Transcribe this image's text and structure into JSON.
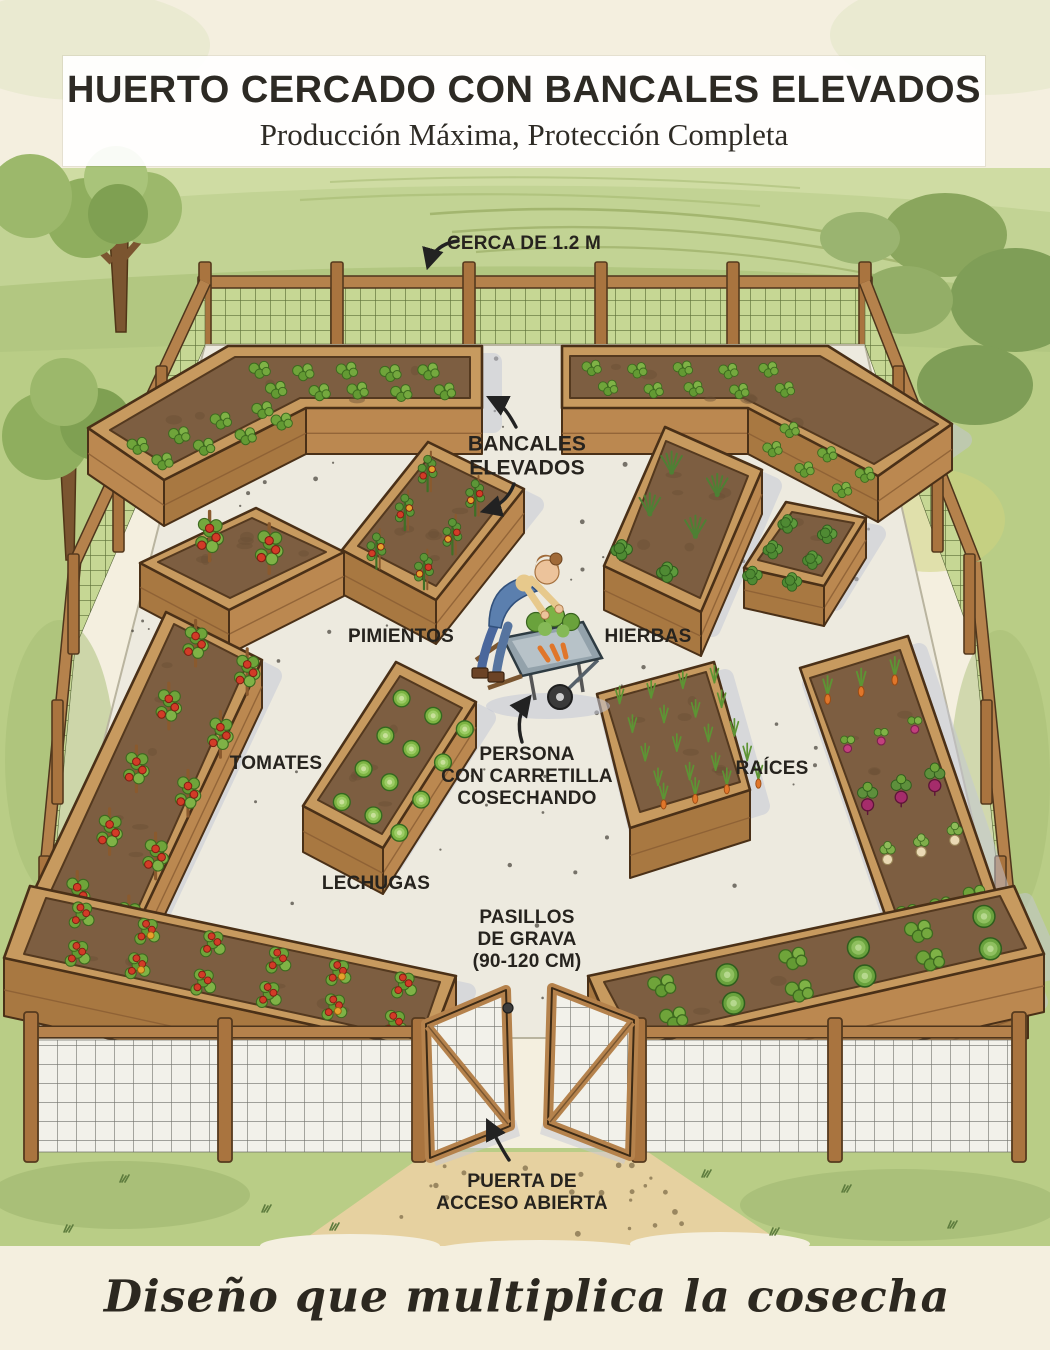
{
  "title": {
    "heading": "HUERTO CERCADO CON BANCALES ELEVADOS",
    "subheading": "Producción Máxima, Protección Completa"
  },
  "labels": {
    "cerca": "CERCA DE 1.2 M",
    "bancales": "BANCALES\nELEVADOS",
    "pimientos": "PIMIENTOS",
    "hierbas": "HIERBAS",
    "tomates": "TOMATES",
    "raices": "RAÍCES",
    "lechugas": "LECHUGAS",
    "persona": "PERSONA\nCON CARRETILLA\nCOSECHANDO",
    "pasillos": "PASILLOS\nDE GRAVA\n(90-120 CM)",
    "puerta": "PUERTA DE\nACCESO ABIERTA"
  },
  "tagline": "Diseño que multiplica la cosecha",
  "palette": {
    "paper": "#f4efdf",
    "ink": "#26231e",
    "gravel": "#edeadf",
    "shadow": "#c3c7d6",
    "woodTop": "#c79a5f",
    "woodFront": "#bb8850",
    "woodSide": "#a87841",
    "woodDark": "#4a3017",
    "soil": "#7d5e41",
    "soilDark": "#54391f",
    "grass": "#b9cd86",
    "meshGreen": "#c6d794",
    "meshLine": "#5d6f38",
    "tomato": "#d23b27",
    "pepperYellow": "#e6a12c",
    "carrot": "#e0762a",
    "beet": "#a52c6b",
    "lettuce": "#7cb342",
    "pathTan": "#e6d1a0"
  },
  "scene": {
    "beds": [
      {
        "name": "bancal-esquina-superior-izquierda",
        "crop": "verduras de hoja",
        "quad": [
          [
            88,
            428
          ],
          [
            228,
            346
          ],
          [
            482,
            346
          ],
          [
            482,
            408
          ],
          [
            306,
            408
          ],
          [
            164,
            480
          ]
        ],
        "soil": [
          [
            235,
            357
          ],
          [
            470,
            357
          ],
          [
            470,
            398
          ],
          [
            300,
            398
          ],
          [
            168,
            466
          ],
          [
            110,
            430
          ]
        ],
        "skirt": [
          [
            3,
            4
          ],
          [
            4,
            5
          ],
          [
            5,
            0
          ]
        ],
        "drop": 46,
        "grids": [
          {
            "type": "leafy",
            "origin": [
              262,
              372
            ],
            "u": [
              42,
              0
            ],
            "v": [
              14,
              20
            ],
            "cols": 5,
            "rows": 2,
            "s": 1.1
          },
          {
            "type": "leafy",
            "origin": [
              140,
              448
            ],
            "u": [
              40,
              -13
            ],
            "v": [
              24,
              14
            ],
            "cols": 4,
            "rows": 2,
            "s": 1.1
          }
        ]
      },
      {
        "name": "bancal-esquina-superior-derecha",
        "crop": "lechugas y hojas",
        "quad": [
          [
            562,
            346
          ],
          [
            828,
            346
          ],
          [
            952,
            424
          ],
          [
            878,
            476
          ],
          [
            748,
            408
          ],
          [
            562,
            408
          ]
        ],
        "soil": [
          [
            570,
            356
          ],
          [
            820,
            356
          ],
          [
            938,
            424
          ],
          [
            874,
            464
          ],
          [
            744,
            398
          ],
          [
            570,
            398
          ]
        ],
        "skirt": [
          [
            5,
            4
          ],
          [
            4,
            3
          ],
          [
            3,
            2
          ]
        ],
        "drop": 46,
        "grids": [
          {
            "type": "leafy",
            "origin": [
              594,
              370
            ],
            "u": [
              44,
              0
            ],
            "v": [
              14,
              20
            ],
            "cols": 5,
            "rows": 2,
            "s": 1.0
          },
          {
            "type": "leafy",
            "origin": [
              792,
              432
            ],
            "u": [
              36,
              22
            ],
            "v": [
              -22,
              16
            ],
            "cols": 3,
            "rows": 2,
            "s": 1.0
          }
        ]
      },
      {
        "name": "bancal-tomates-cuadrado",
        "crop": "tomates",
        "quad": [
          [
            140,
            563
          ],
          [
            256,
            508
          ],
          [
            344,
            552
          ],
          [
            229,
            610
          ]
        ],
        "soil": [
          [
            158,
            562
          ],
          [
            252,
            518
          ],
          [
            326,
            552
          ],
          [
            230,
            598
          ]
        ],
        "skirt": [
          [
            2,
            3
          ],
          [
            3,
            0
          ]
        ],
        "drop": 44,
        "grids": [
          {
            "type": "tomato-stake",
            "origin": [
              212,
              552
            ],
            "u": [
              58,
              10
            ],
            "v": [
              0,
              0
            ],
            "cols": 2,
            "rows": 1,
            "s": 1.3
          }
        ]
      },
      {
        "name": "bancal-pimientos",
        "crop": "pimientos",
        "quad": [
          [
            428,
            442
          ],
          [
            524,
            489
          ],
          [
            436,
            600
          ],
          [
            342,
            550
          ]
        ],
        "soil": [
          [
            430,
            456
          ],
          [
            508,
            494
          ],
          [
            436,
            586
          ],
          [
            358,
            546
          ]
        ],
        "skirt": [
          [
            1,
            2
          ],
          [
            2,
            3
          ]
        ],
        "drop": 44,
        "grids": [
          {
            "type": "pepper",
            "origin": [
              430,
              484
            ],
            "u": [
              46,
              22
            ],
            "v": [
              -26,
              38
            ],
            "cols": 2,
            "rows": 3,
            "s": 1.1
          }
        ]
      },
      {
        "name": "bancal-hierbas",
        "crop": "hierbas aromáticas",
        "quad": [
          [
            665,
            427
          ],
          [
            762,
            470
          ],
          [
            701,
            612
          ],
          [
            604,
            566
          ]
        ],
        "soil": [
          [
            666,
            441
          ],
          [
            748,
            476
          ],
          [
            700,
            598
          ],
          [
            620,
            560
          ]
        ],
        "skirt": [
          [
            1,
            2
          ],
          [
            2,
            3
          ]
        ],
        "drop": 44,
        "grids": [
          {
            "type": "spiky",
            "origin": [
              674,
              468
            ],
            "u": [
              44,
              20
            ],
            "v": [
              -25,
              41
            ],
            "cols": 2,
            "rows": 2,
            "s": 1.15
          },
          {
            "type": "bush",
            "origin": [
              624,
              552
            ],
            "u": [
              44,
              20
            ],
            "v": [
              0,
              0
            ],
            "cols": 2,
            "rows": 1,
            "s": 1.1
          }
        ]
      },
      {
        "name": "bancal-arbustos-derecho",
        "crop": "matas verdes",
        "quad": [
          [
            786,
            502
          ],
          [
            866,
            518
          ],
          [
            824,
            586
          ],
          [
            744,
            568
          ]
        ],
        "soil": [
          [
            792,
            512
          ],
          [
            854,
            523
          ],
          [
            822,
            576
          ],
          [
            758,
            560
          ]
        ],
        "skirt": [
          [
            1,
            2
          ],
          [
            2,
            3
          ]
        ],
        "drop": 40,
        "grids": [
          {
            "type": "bush",
            "origin": [
              790,
              526
            ],
            "u": [
              38,
              8
            ],
            "v": [
              -18,
              25
            ],
            "cols": 2,
            "rows": 3,
            "s": 1.0
          }
        ]
      },
      {
        "name": "bancal-tomates-largo",
        "crop": "tomates",
        "quad": [
          [
            166,
            612
          ],
          [
            262,
            660
          ],
          [
            120,
            962
          ],
          [
            26,
            908
          ]
        ],
        "soil": [
          [
            174,
            624
          ],
          [
            248,
            662
          ],
          [
            122,
            944
          ],
          [
            44,
            906
          ]
        ],
        "skirt": [
          [
            1,
            2
          ],
          [
            2,
            3
          ]
        ],
        "drop": 48,
        "grids": [
          {
            "type": "tomato-stake",
            "origin": [
              198,
              658
            ],
            "u": [
              50,
              26
            ],
            "v": [
              -30,
              62
            ],
            "cols": 2,
            "rows": 5,
            "s": 1.2
          }
        ]
      },
      {
        "name": "bancal-lechugas",
        "crop": "lechugas",
        "quad": [
          [
            396,
            662
          ],
          [
            476,
            702
          ],
          [
            383,
            848
          ],
          [
            303,
            806
          ]
        ],
        "soil": [
          [
            400,
            676
          ],
          [
            462,
            708
          ],
          [
            382,
            834
          ],
          [
            318,
            800
          ]
        ],
        "skirt": [
          [
            1,
            2
          ],
          [
            2,
            3
          ]
        ],
        "drop": 46,
        "grids": [
          {
            "type": "lettuce",
            "origin": [
              404,
              700
            ],
            "u": [
              30,
              15
            ],
            "v": [
              -21,
              34
            ],
            "cols": 3,
            "rows": 4,
            "s": 1.05
          }
        ]
      },
      {
        "name": "bancal-zanahorias",
        "crop": "zanahorias",
        "quad": [
          [
            597,
            694
          ],
          [
            714,
            662
          ],
          [
            750,
            790
          ],
          [
            630,
            828
          ]
        ],
        "soil": [
          [
            606,
            700
          ],
          [
            706,
            672
          ],
          [
            740,
            782
          ],
          [
            640,
            812
          ]
        ],
        "skirt": [
          [
            1,
            2
          ],
          [
            2,
            3
          ]
        ],
        "drop": 50,
        "grids": [
          {
            "type": "carrot",
            "origin": [
              622,
              700
            ],
            "u": [
              30,
              -8
            ],
            "v": [
              12,
              27
            ],
            "cols": 4,
            "rows": 4,
            "s": 1.0
          },
          {
            "type": "carrot-root",
            "origin": [
              666,
              798
            ],
            "u": [
              30,
              -8
            ],
            "v": [
              0,
              0
            ],
            "cols": 4,
            "rows": 1,
            "s": 1.0
          }
        ]
      },
      {
        "name": "bancal-raices",
        "crop": "raíces",
        "quad": [
          [
            800,
            668
          ],
          [
            908,
            636
          ],
          [
            1028,
            986
          ],
          [
            922,
            1022
          ]
        ],
        "soil": [
          [
            810,
            678
          ],
          [
            900,
            650
          ],
          [
            1014,
            978
          ],
          [
            930,
            1006
          ]
        ],
        "skirt": [
          [
            1,
            2
          ],
          [
            2,
            3
          ]
        ],
        "drop": 52,
        "grids": [
          {
            "type": "carrot-root",
            "origin": [
              830,
              692
            ],
            "u": [
              32,
              -10
            ],
            "v": [
              0,
              0
            ],
            "cols": 3,
            "rows": 1,
            "s": 1.1
          },
          {
            "type": "radish",
            "origin": [
              850,
              748
            ],
            "u": [
              32,
              -10
            ],
            "v": [
              0,
              0
            ],
            "cols": 3,
            "rows": 1,
            "s": 1.1
          },
          {
            "type": "beet",
            "origin": [
              870,
              804
            ],
            "u": [
              32,
              -10
            ],
            "v": [
              0,
              0
            ],
            "cols": 3,
            "rows": 1,
            "s": 1.2
          },
          {
            "type": "turnip",
            "origin": [
              890,
              860
            ],
            "u": [
              32,
              -10
            ],
            "v": [
              0,
              0
            ],
            "cols": 3,
            "rows": 1,
            "s": 1.1
          },
          {
            "type": "leafy",
            "origin": [
              910,
              916
            ],
            "u": [
              32,
              -10
            ],
            "v": [
              0,
              0
            ],
            "cols": 3,
            "rows": 1,
            "s": 1.2
          },
          {
            "type": "cabbage",
            "origin": [
              932,
              970
            ],
            "u": [
              34,
              -11
            ],
            "v": [
              0,
              0
            ],
            "cols": 2,
            "rows": 1,
            "s": 1.3
          }
        ]
      },
      {
        "name": "bancal-inferior-izquierdo",
        "crop": "tomates y pimientos",
        "quad": [
          [
            30,
            886
          ],
          [
            456,
            976
          ],
          [
            428,
            1050
          ],
          [
            4,
            958
          ]
        ],
        "soil": [
          [
            46,
            898
          ],
          [
            440,
            982
          ],
          [
            420,
            1040
          ],
          [
            24,
            954
          ]
        ],
        "skirt": [
          [
            1,
            2
          ],
          [
            2,
            3
          ]
        ],
        "drop": 58,
        "grids": [
          {
            "type": "tomato-bush",
            "origin": [
              84,
              924
            ],
            "u": [
              64,
              14
            ],
            "v": [
              -8,
              36
            ],
            "cols": 6,
            "rows": 2,
            "s": 1.15
          }
        ]
      },
      {
        "name": "bancal-inferior-derecho",
        "crop": "verduras mixtas",
        "quad": [
          [
            588,
            976
          ],
          [
            1014,
            886
          ],
          [
            1044,
            954
          ],
          [
            620,
            1050
          ]
        ],
        "soil": [
          [
            604,
            982
          ],
          [
            1000,
            896
          ],
          [
            1026,
            948
          ],
          [
            634,
            1038
          ]
        ],
        "skirt": [
          [
            2,
            3
          ],
          [
            3,
            0
          ]
        ],
        "drop": 58,
        "grids": [
          {
            "type": "mixed-greens",
            "origin": [
              664,
              988
            ],
            "u": [
              64,
              -14
            ],
            "v": [
              8,
              30
            ],
            "cols": 6,
            "rows": 2,
            "s": 1.15
          }
        ]
      }
    ]
  }
}
